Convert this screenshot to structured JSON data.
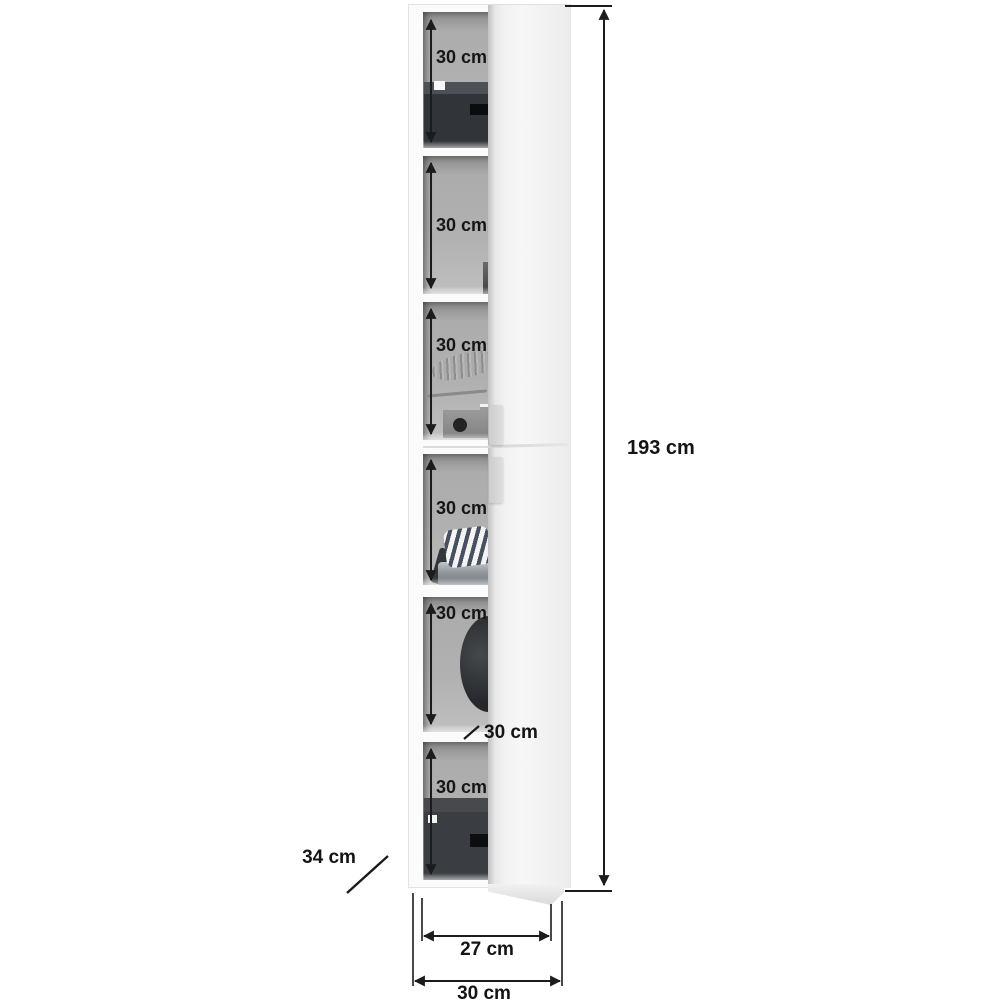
{
  "diagram": {
    "title": "tall-cabinet-dimension-diagram",
    "compartments": [
      {
        "label": "30 cm",
        "content": "storage-box"
      },
      {
        "label": "30 cm",
        "content": "empty"
      },
      {
        "label": "30 cm",
        "content": "shoe-and-storage-box"
      },
      {
        "label": "30 cm",
        "content": "folded-textiles"
      },
      {
        "label": "30 cm",
        "content": "round-bag"
      },
      {
        "label": "30 cm",
        "content": "storage-box"
      }
    ],
    "dimensions": {
      "total_height": "193 cm",
      "depth": "34 cm",
      "inner_width": "27 cm",
      "outer_width": "30 cm",
      "shelf_depth": "30 cm"
    },
    "colors": {
      "line": "#1c1c1c",
      "interior": "#b0b0b0",
      "door": "#f3f3f3",
      "box": "#35383b",
      "background": "#ffffff"
    }
  }
}
